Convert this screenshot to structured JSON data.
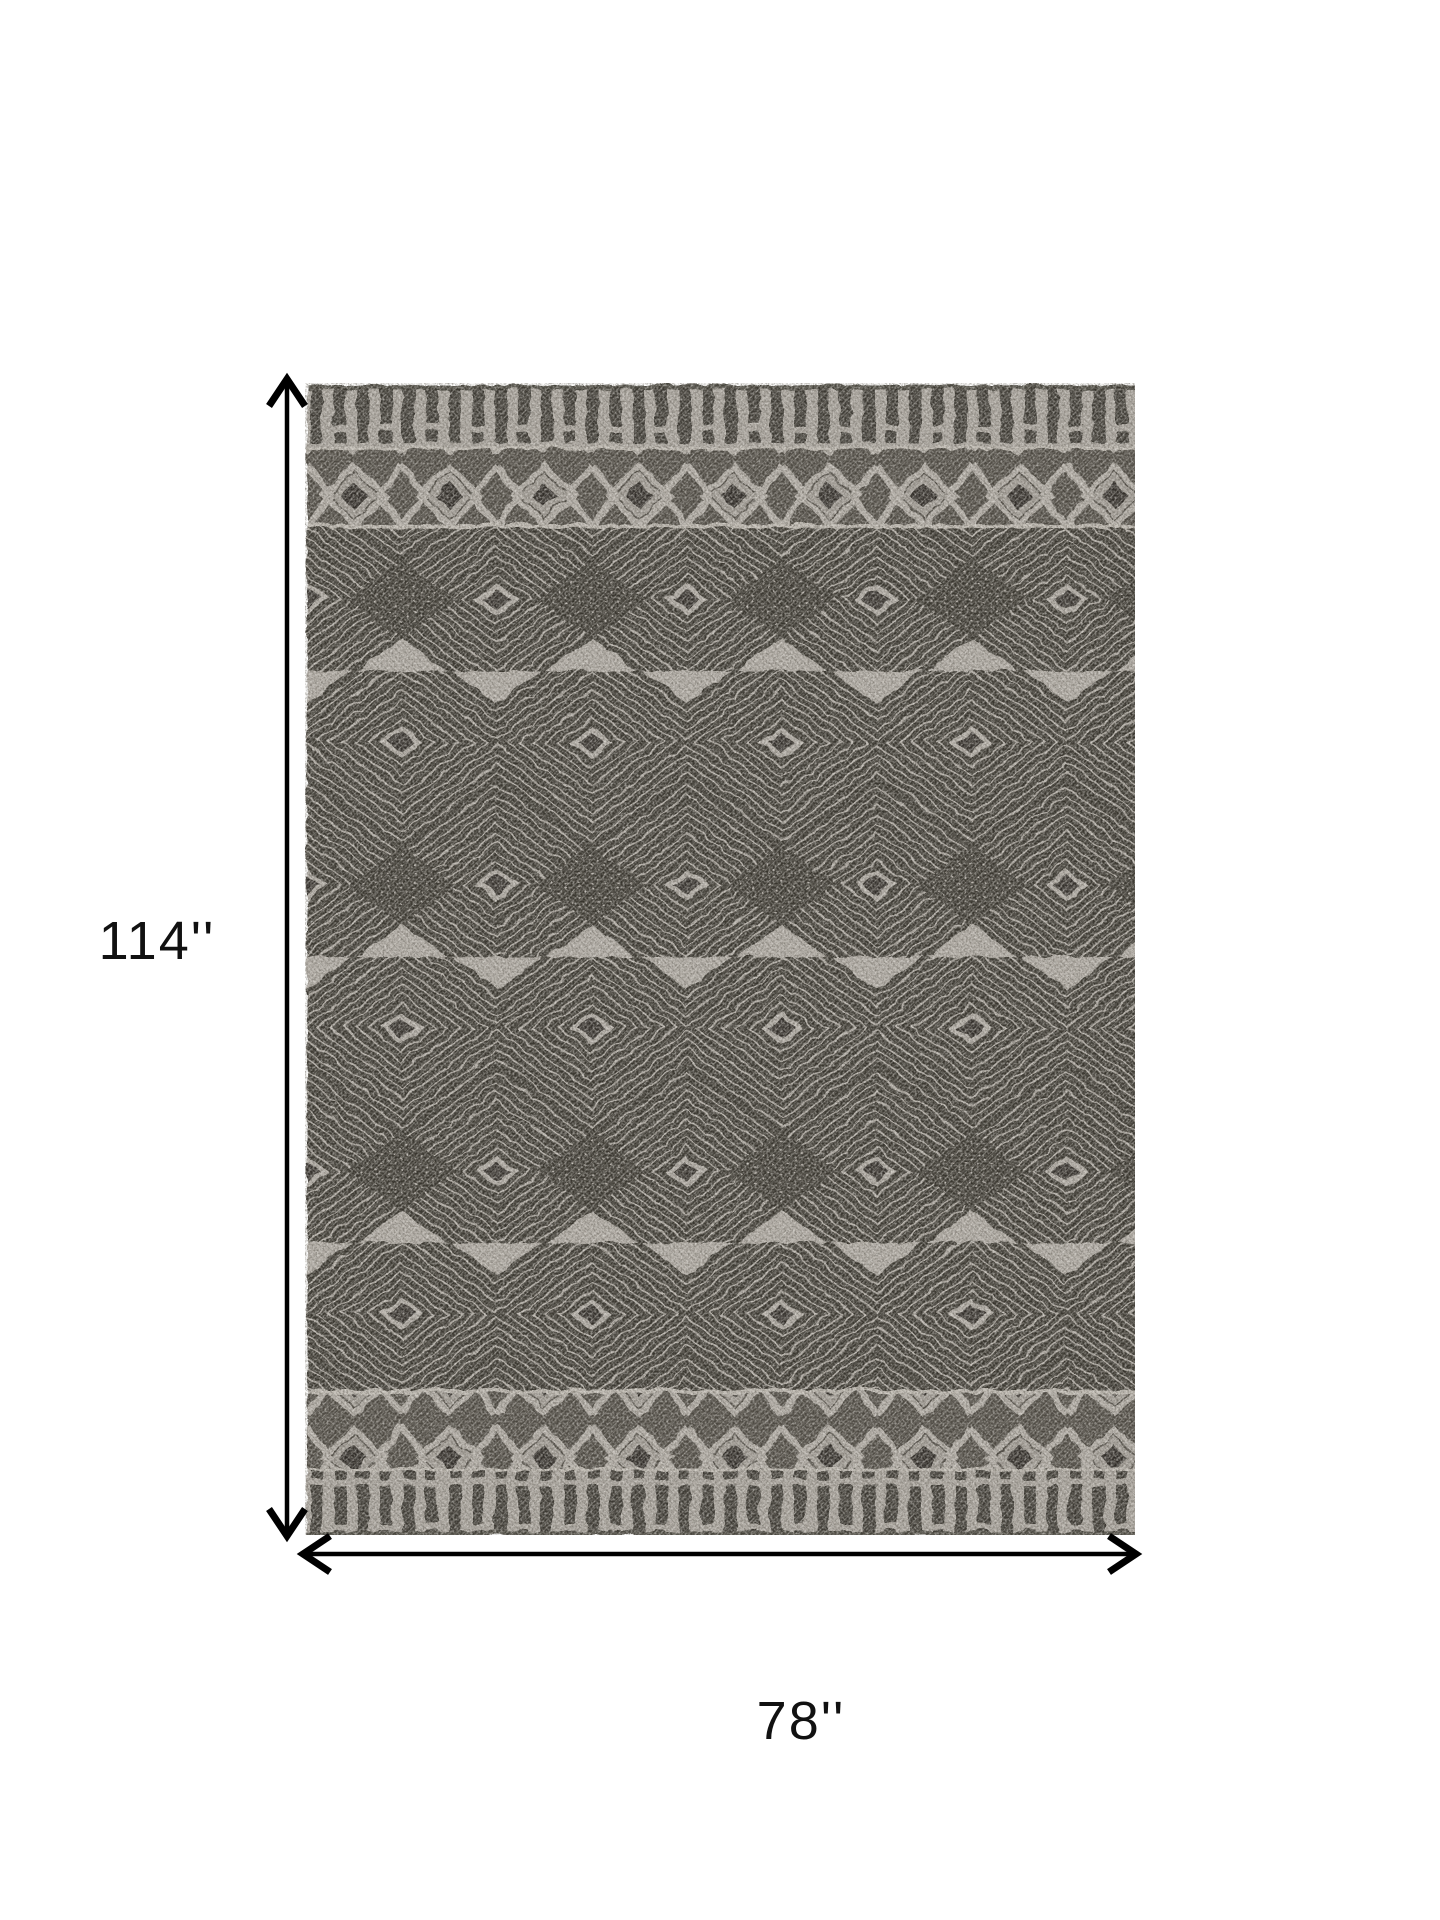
{
  "page": {
    "background_color": "#ffffff"
  },
  "diagram": {
    "type": "product-dimensions",
    "subject": "geometric-pattern-rug",
    "height_label": "114''",
    "width_label": "78''",
    "colors": {
      "rug_light": "#b0aba4",
      "rug_dark": "#39362f",
      "band_background": "#4e4a43",
      "arrow": "#000000",
      "label_text": "#111111"
    }
  }
}
